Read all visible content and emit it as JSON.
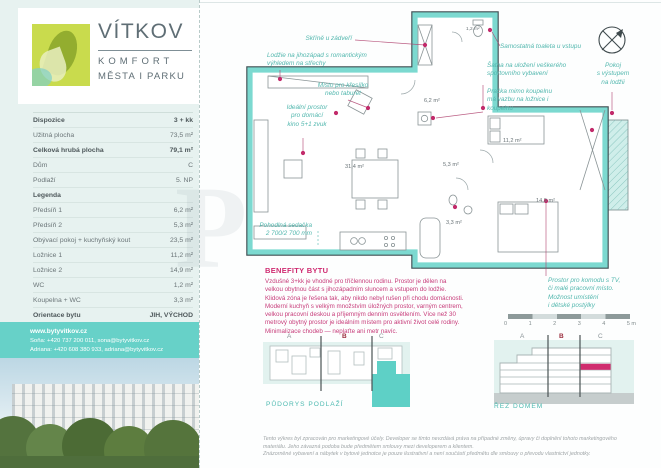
{
  "colors": {
    "accent_teal": "#66d1c8",
    "magenta": "#cf2a70"
  },
  "brand": {
    "name": "VÍTKOV",
    "sub1": "KOMFORT",
    "sub2": "MĚSTA I PARKU"
  },
  "specs": {
    "rows": [
      {
        "label": "Dispozice",
        "value": "3 + kk"
      },
      {
        "label": "Užitná plocha",
        "value": "73,5 m²"
      },
      {
        "label": "Celková hrubá plocha",
        "value": "79,1 m²"
      },
      {
        "label": "Dům",
        "value": "C"
      },
      {
        "label": "Podlaží",
        "value": "5. NP"
      },
      {
        "label": "Legenda",
        "value": ""
      },
      {
        "label": "Předsíň 1",
        "value": "6,2 m²"
      },
      {
        "label": "Předsíň 2",
        "value": "5,3 m²"
      },
      {
        "label": "Obývací pokoj + kuchyňský kout",
        "value": "23,5 m²"
      },
      {
        "label": "Ložnice 1",
        "value": "11,2 m²"
      },
      {
        "label": "Ložnice 2",
        "value": "14,9 m²"
      },
      {
        "label": "WC",
        "value": "1,2 m²"
      },
      {
        "label": "Koupelna + WC",
        "value": "3,3 m²"
      },
      {
        "label": "Orientace bytu",
        "value": "JIH, VÝCHOD"
      }
    ]
  },
  "contact": {
    "web": "www.bytyvitkov.cz",
    "line2": "Soňa: +420 737 200 011, sona@bytyvitkov.cz",
    "line3": "Adriana: +420 608 380 933, adriana@bytyvitkov.cz"
  },
  "plan": {
    "areas": {
      "living": "31,4 m²",
      "wc": "1,2 m²",
      "hall1": "6,2 m²",
      "hall2": "5,3 m²",
      "bath": "3,3 m²",
      "bedroom1": "11,2 m²",
      "bedroom2": "14,9 m²"
    },
    "annotations": {
      "wardrobe": "Skříně u zádveří",
      "loggia": "Lodžie na jihozápad s romantickým\nvýhledem na střechy",
      "armchair": "Místo pro křesílko\nnebo taburet",
      "cinema": "Ideální prostor\npro domácí\nkino 5+1 zvuk",
      "toilet": "Samostatná toaleta u vstupu",
      "closet": "Šatna na uložení veškerého\nsportovního vybavení",
      "washer": "Pračka mimo koupelnu\nmá vazbu na ložnice i\nkoupelnu",
      "room": "Pokoj\ns výstupem\nna lodžii",
      "sofa": "Pohodlná sedačka\n2 700/2 700 mm",
      "commode": "Prostor pro komodu s TV,\nči malé pracovní místo.\nMožnost umístění\ni dětské postýlky"
    }
  },
  "scalebar": {
    "labels": [
      "0",
      "1",
      "2",
      "3",
      "4",
      "5 m"
    ]
  },
  "benefits": {
    "title": "BENEFITY BYTU",
    "body": "Vzdušné 3+kk je vhodné pro tříčlennou rodinu. Prostor je dělen na velkou obytnou část s jihozápadním sluncem a vstupem do lodžie. Klidová zóna je řešena tak, aby nikdo nebyl rušen při chodu domácnosti. Moderní kuchyň s velkým množstvím úložných prostor, varným centrem, velkou pracovní deskou a příjemným denním osvětlením. Více než 30 metrový obytný prostor je ideálním místem pro aktivní život celé rodiny. Minimalizace chodeb — neplaťte ani metr navíc."
  },
  "diagrams": {
    "plan": {
      "caption": "PŮDORYS PODLAŽÍ",
      "sections": [
        "A",
        "B",
        "C"
      ]
    },
    "section": {
      "caption": "ŘEZ DOMEM",
      "sections": [
        "A",
        "B",
        "C"
      ]
    }
  },
  "disclaimer": {
    "text": "Tento výkres byl zpracován pro marketingové účely. Developer se tímto nevzdává práva na případné změny, úpravy či doplnění tohoto marketingového\nmateriálu. Jeho závazná podoba bude předmětem smlouvy mezi developerem a klientem.\nZnázorněné vybavení a nábytek v bytové jednotce je pouze ilustrativní a není součástí předmětu dle smlouvy o převodu vlastnictví jednotky."
  },
  "watermark": "P"
}
